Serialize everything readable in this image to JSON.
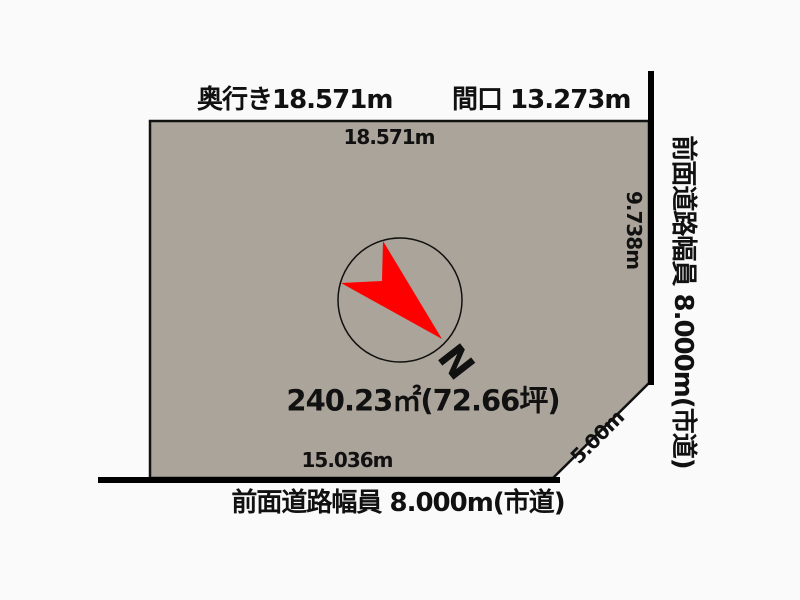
{
  "background_color": "#fafafa",
  "plot": {
    "fill_color": "#aba49a",
    "outline_color": "#111111",
    "area_label": "240.23㎡(72.66坪)",
    "dimensions": {
      "top_edge": "18.571m",
      "right_edge": "9.738m",
      "bottom_edge": "15.036m",
      "corner_cut_edge": "5.00m"
    }
  },
  "labels": {
    "depth": "奥行き18.571m",
    "frontage": "間口 13.273m",
    "right_road": "前面道路幅員 8.000m(市道)",
    "bottom_road": "前面道路幅員 8.000m(市道)"
  },
  "compass": {
    "north_letter": "N",
    "arrow_color": "#ff0000",
    "ring_color": "#111111"
  }
}
